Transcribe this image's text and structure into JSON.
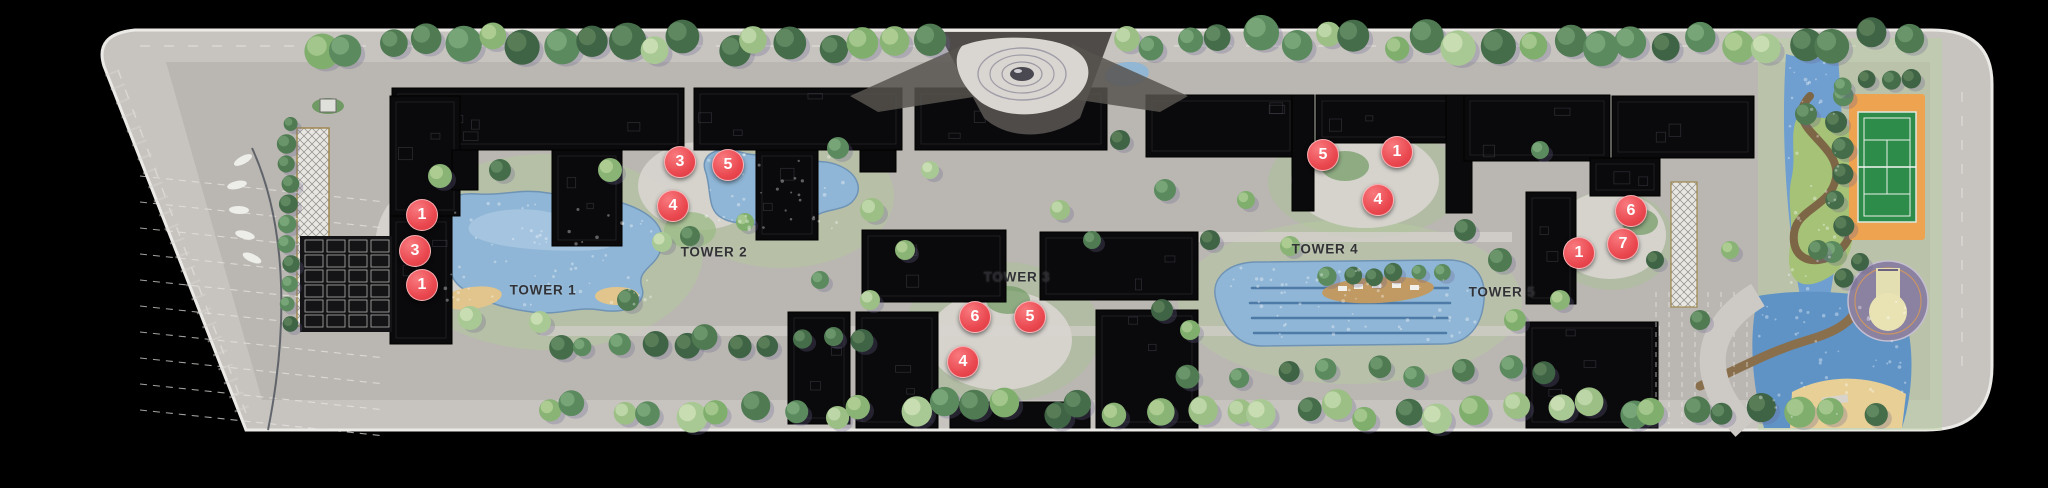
{
  "site_plan": {
    "tower_labels": [
      {
        "label": "TOWER 1",
        "x": 543,
        "y": 290
      },
      {
        "label": "TOWER 2",
        "x": 714,
        "y": 252
      },
      {
        "label": "TOWER 3",
        "x": 1017,
        "y": 277
      },
      {
        "label": "TOWER 4",
        "x": 1325,
        "y": 249
      },
      {
        "label": "TOWER 5",
        "x": 1502,
        "y": 292
      }
    ],
    "markers": [
      {
        "number": "1",
        "x": 422,
        "y": 215
      },
      {
        "number": "3",
        "x": 415,
        "y": 251
      },
      {
        "number": "1",
        "x": 422,
        "y": 285
      },
      {
        "number": "3",
        "x": 680,
        "y": 162
      },
      {
        "number": "5",
        "x": 728,
        "y": 165
      },
      {
        "number": "4",
        "x": 673,
        "y": 206
      },
      {
        "number": "6",
        "x": 975,
        "y": 317
      },
      {
        "number": "5",
        "x": 1030,
        "y": 317
      },
      {
        "number": "4",
        "x": 963,
        "y": 362
      },
      {
        "number": "5",
        "x": 1323,
        "y": 155
      },
      {
        "number": "1",
        "x": 1397,
        "y": 152
      },
      {
        "number": "4",
        "x": 1378,
        "y": 200
      },
      {
        "number": "6",
        "x": 1631,
        "y": 211
      },
      {
        "number": "7",
        "x": 1623,
        "y": 244
      },
      {
        "number": "1",
        "x": 1579,
        "y": 253
      }
    ],
    "colors": {
      "background": "#000000",
      "marker_red": "#ea474f",
      "marker_text": "#ffffff",
      "label_text": "#2b2b30",
      "water": "#8fb6d6",
      "deep_water": "#5f93c6",
      "building": "#0a0a0c",
      "pavement": "#bab7b2",
      "road": "#c7c4c0",
      "tennis_court_green": "#2e8c4a",
      "tennis_apron_orange": "#eda34f",
      "basketball_purple": "#8b81a0",
      "sand": "#e2c58c",
      "lawn_green": "#b3c89c",
      "tree_green": "#5b8a5e",
      "boardwalk_brown": "#8a6f4d"
    }
  }
}
